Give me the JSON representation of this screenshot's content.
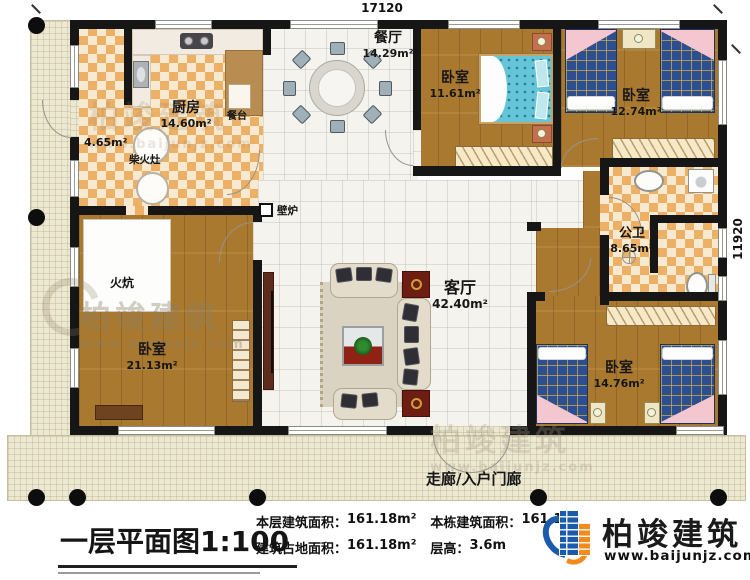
{
  "plan": {
    "dimensions": {
      "top": "17120",
      "right": "11920"
    },
    "rooms": [
      {
        "name": "厨房",
        "area": "14.60m²"
      },
      {
        "name": "餐厅",
        "area": "14.29m²"
      },
      {
        "name": "卧室",
        "area": "11.61m²"
      },
      {
        "name": "卧室",
        "area": "12.74m²"
      },
      {
        "name": "公卫",
        "area": "8.65m²"
      },
      {
        "name": "客厅",
        "area": "42.40m²"
      },
      {
        "name": "卧室",
        "area": "21.13m²"
      },
      {
        "name": "卧室",
        "area": "14.76m²"
      },
      {
        "name": "",
        "area": "4.65m²"
      }
    ],
    "features": {
      "dining_counter": "餐台",
      "firewood_stove": "柴火灶",
      "fireplace": "壁炉",
      "kang_bed": "火炕",
      "entry_porch": "走廊/入户门廊"
    }
  },
  "title_block": {
    "plan_title": "一层平面图",
    "plan_scale": "1:100",
    "stats": [
      {
        "label": "本层建筑面积：",
        "value": "161.18m²"
      },
      {
        "label": "本栋建筑面积：",
        "value": "161.1"
      },
      {
        "label": "建筑占地面积：",
        "value": "161.18m²"
      },
      {
        "label": "层高：",
        "value": "3.6m"
      }
    ],
    "logo": {
      "name": "柏竣建筑",
      "website": "www.baijunjz.com"
    },
    "brand_colors": {
      "blue": "#1b5bab",
      "orange": "#f28a1e"
    }
  },
  "watermark": {
    "name": "柏竣建筑",
    "website": "www.baijunjz.com"
  }
}
